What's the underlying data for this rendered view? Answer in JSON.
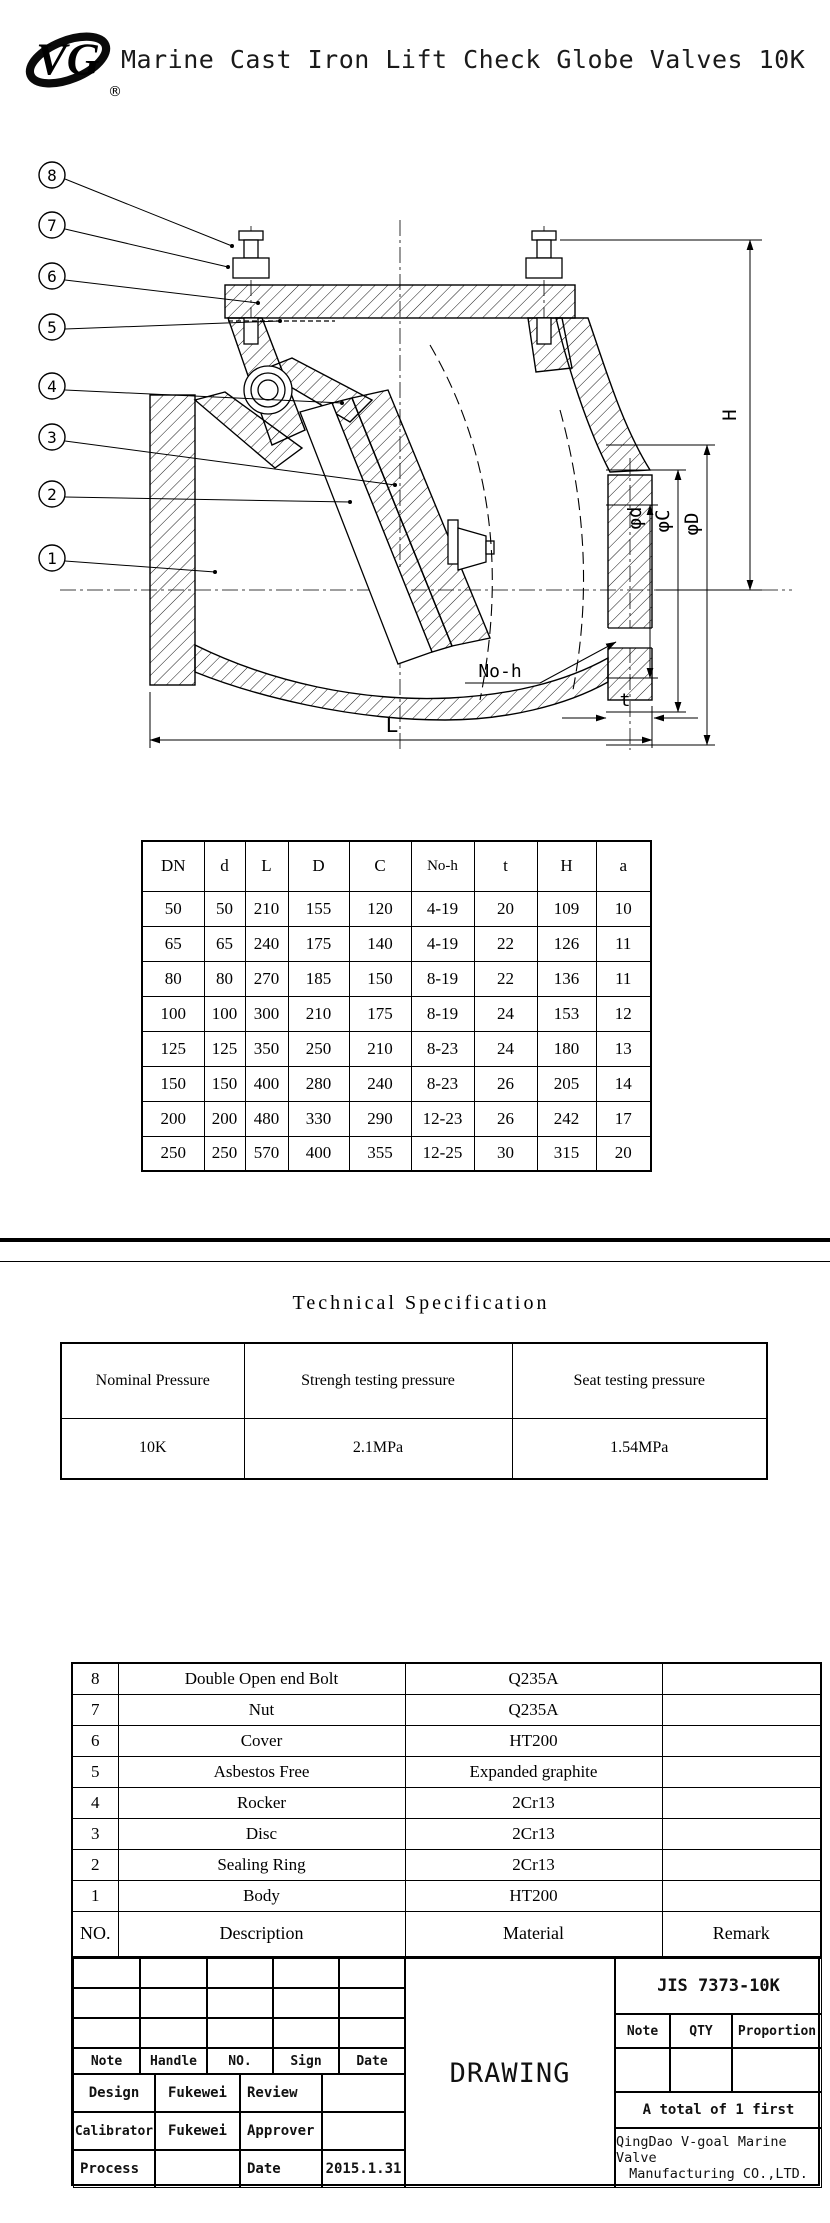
{
  "header": {
    "title": "Marine Cast Iron Lift Check Globe Valves 10K",
    "logo_text": "VG",
    "registered": "®"
  },
  "drawing": {
    "callouts": [
      "8",
      "7",
      "6",
      "5",
      "4",
      "3",
      "2",
      "1"
    ],
    "dim_labels": {
      "H": "H",
      "phi_d": "φd",
      "phi_C": "φC",
      "phi_D": "φD",
      "no_h": "No-h",
      "t": "t",
      "L": "L"
    }
  },
  "dimension_table": {
    "headers": [
      "DN",
      "d",
      "L",
      "D",
      "C",
      "No-h",
      "t",
      "H",
      "a"
    ],
    "rows": [
      [
        "50",
        "50",
        "210",
        "155",
        "120",
        "4-19",
        "20",
        "109",
        "10"
      ],
      [
        "65",
        "65",
        "240",
        "175",
        "140",
        "4-19",
        "22",
        "126",
        "11"
      ],
      [
        "80",
        "80",
        "270",
        "185",
        "150",
        "8-19",
        "22",
        "136",
        "11"
      ],
      [
        "100",
        "100",
        "300",
        "210",
        "175",
        "8-19",
        "24",
        "153",
        "12"
      ],
      [
        "125",
        "125",
        "350",
        "250",
        "210",
        "8-23",
        "24",
        "180",
        "13"
      ],
      [
        "150",
        "150",
        "400",
        "280",
        "240",
        "8-23",
        "26",
        "205",
        "14"
      ],
      [
        "200",
        "200",
        "480",
        "330",
        "290",
        "12-23",
        "26",
        "242",
        "17"
      ],
      [
        "250",
        "250",
        "570",
        "400",
        "355",
        "12-25",
        "30",
        "315",
        "20"
      ]
    ]
  },
  "technical_specification": {
    "title": "Technical Specification",
    "headers": [
      "Nominal Pressure",
      "Strengh testing pressure",
      "Seat testing pressure"
    ],
    "values": [
      "10K",
      "2.1MPa",
      "1.54MPa"
    ]
  },
  "parts_list": {
    "rows": [
      [
        "8",
        "Double Open end Bolt",
        "Q235A",
        ""
      ],
      [
        "7",
        "Nut",
        "Q235A",
        ""
      ],
      [
        "6",
        "Cover",
        "HT200",
        ""
      ],
      [
        "5",
        "Asbestos Free",
        "Expanded graphite",
        ""
      ],
      [
        "4",
        "Rocker",
        "2Cr13",
        ""
      ],
      [
        "3",
        "Disc",
        "2Cr13",
        ""
      ],
      [
        "2",
        "Sealing Ring",
        "2Cr13",
        ""
      ],
      [
        "1",
        "Body",
        "HT200",
        ""
      ]
    ],
    "footer": [
      "NO.",
      "Description",
      "Material",
      "Remark"
    ]
  },
  "title_block": {
    "sign_header": [
      "Note",
      "Handle",
      "NO.",
      "Sign",
      "Date"
    ],
    "rows": [
      {
        "label1": "Design",
        "value1": "Fukewei",
        "label2": "Review",
        "value2": ""
      },
      {
        "label1": "Calibrator",
        "value1": "Fukewei",
        "label2": "Approver",
        "value2": ""
      },
      {
        "label1": "Process",
        "value1": "",
        "label2": "Date",
        "value2": "2015.1.31"
      }
    ],
    "drawing_label": "DRAWING",
    "standard": "JIS 7373-10K",
    "qty_header": [
      "Note",
      "QTY",
      "Proportion"
    ],
    "total_note": "A total of 1 first",
    "company_line1": "QingDao V-goal Marine Valve",
    "company_line2": "Manufacturing CO.,LTD."
  }
}
